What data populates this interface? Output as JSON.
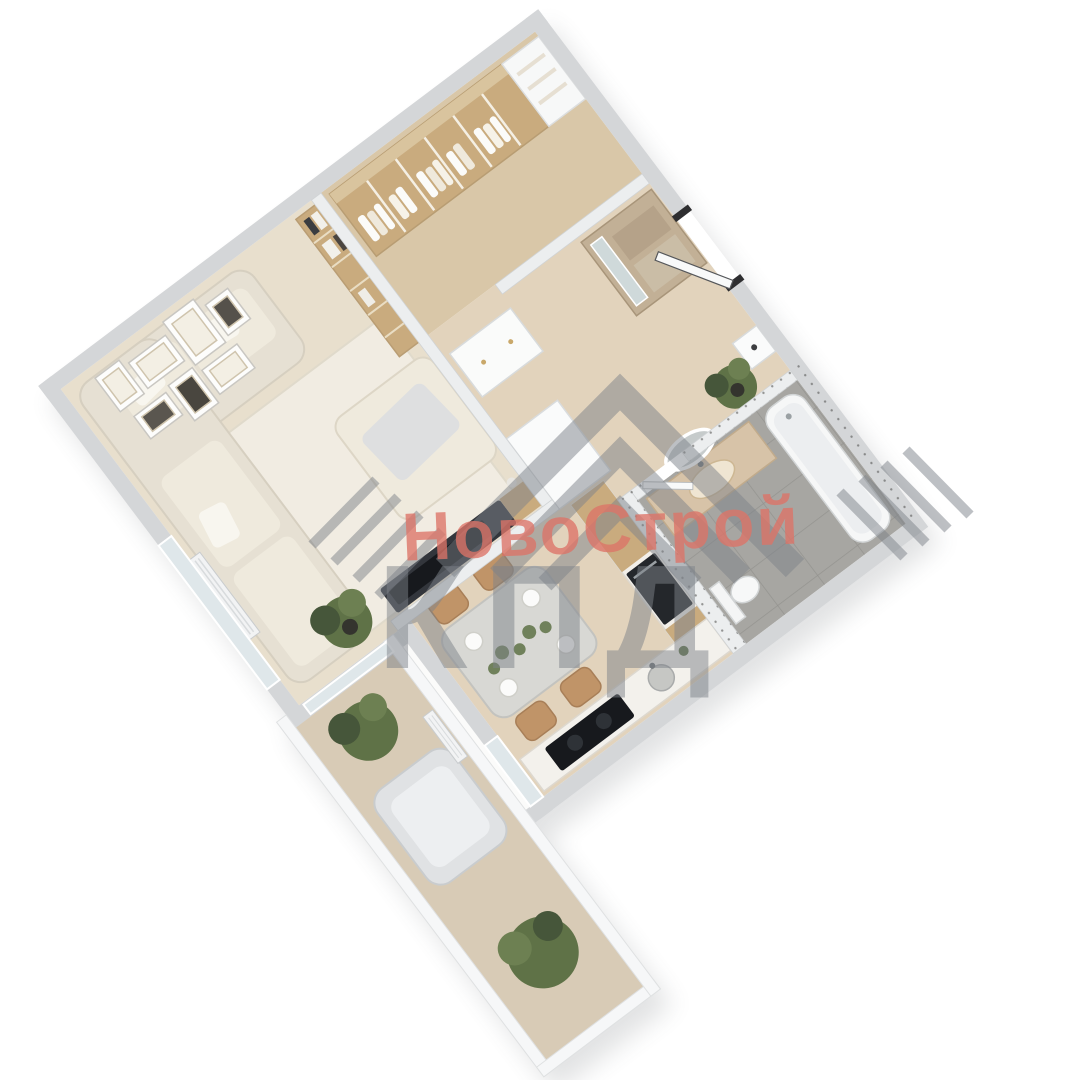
{
  "watermark": {
    "brand": "НовоСтрой",
    "company": "КПД"
  },
  "colors": {
    "wall_outer": "#d4d6d8",
    "wall_inner": "#eceeef",
    "wall_white": "#f6f7f8",
    "floor_living": "#e8dfcd",
    "floor_wood_warm": "#d9c7a8",
    "floor_corridor": "#e2d3bc",
    "floor_balcony": "#d8cbb6",
    "floor_tile": "#a7a6a2",
    "rug": "#f1ece2",
    "sofa": "#e6e0d3",
    "cushion": "#efeadd",
    "wood_tan": "#c9ab7e",
    "dark_appliance": "#24272b",
    "tv_dark": "#33363c",
    "chair_tan": "#c09468",
    "table_top": "#d8d8d4",
    "plant_green": "#5f7247",
    "plant_dark": "#46563a",
    "vanity_beige": "#d7c3a8",
    "glass": "#dfe7ea",
    "wm_red": "#dd7468",
    "wm_gray": "#7e838a",
    "shadow": "#50545a"
  }
}
